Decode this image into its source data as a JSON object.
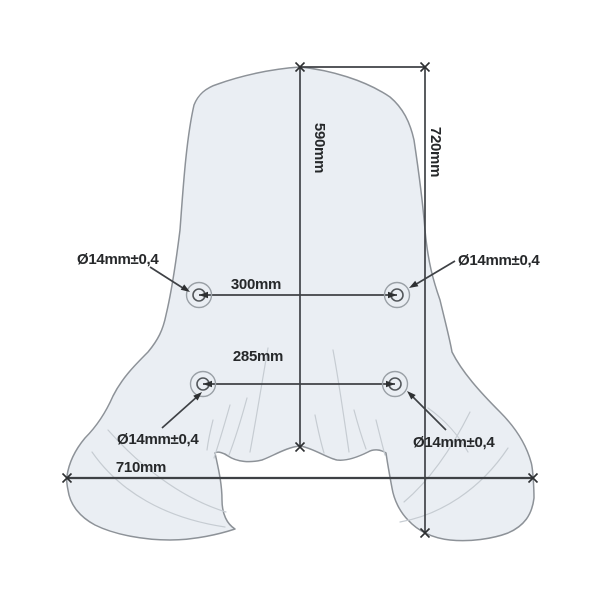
{
  "diagram": {
    "labels": {
      "dim_center_height": "590mm",
      "dim_total_height": "720mm",
      "dim_upper_hole_spacing": "300mm",
      "dim_lower_hole_spacing": "285mm",
      "dim_bottom_width": "710mm",
      "hole_upper_left": "Ø14mm±0,4",
      "hole_upper_right": "Ø14mm±0,4",
      "hole_lower_left": "Ø14mm±0,4",
      "hole_lower_right": "Ø14mm±0,4"
    },
    "colors": {
      "background": "#ffffff",
      "shield_fill": "#eaeef3",
      "shield_outline": "#8d9298",
      "crease_line": "#c6ccd2",
      "dimension_line": "#3e4145",
      "label_text": "#26282a"
    }
  }
}
